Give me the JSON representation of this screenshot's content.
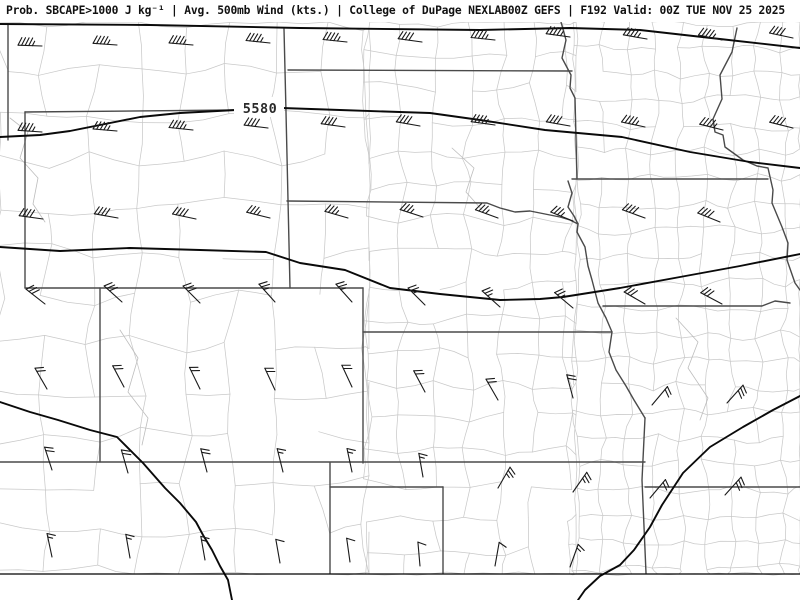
{
  "title": {
    "text": "Prob. SBCAPE>1000 J kg⁻¹ | Avg. 500mb Wind (kts.) | College of DuPage NEXLAB00Z GEFS | F192 Valid: 00Z TUE NOV 25 2025"
  },
  "map": {
    "width": 800,
    "height": 600,
    "top": 22,
    "bottom_frame_y": 574,
    "background": "#ffffff",
    "colors": {
      "county": "#c9c9c9",
      "state_border": "#4a4a4a",
      "contour": "#0a0a0a",
      "wind_barb": "#1a1a1a",
      "frame": "#000000",
      "title_text": "#111111",
      "label_text": "#2a2a2a",
      "decor_river": "#bdbdbd"
    },
    "contour_label": {
      "text": "5580",
      "x": 260,
      "y": 113,
      "box": {
        "x": 234,
        "y": 97,
        "w": 50,
        "h": 20
      }
    },
    "county_regions": [
      {
        "x0": 0,
        "y0": 22,
        "x1": 369,
        "y1": 574,
        "cell": 46,
        "jitter": 9,
        "drop": 0.22,
        "seed": 7
      },
      {
        "x0": 369,
        "y0": 22,
        "x1": 576,
        "y1": 574,
        "cell": 33,
        "jitter": 6,
        "drop": 0.12,
        "seed": 13
      },
      {
        "x0": 576,
        "y0": 22,
        "x1": 800,
        "y1": 574,
        "cell": 26,
        "jitter": 5,
        "drop": 0.07,
        "seed": 29
      }
    ],
    "decor_rivers": [
      [
        [
          10,
          118
        ],
        [
          28,
          132
        ],
        [
          20,
          158
        ],
        [
          38,
          178
        ],
        [
          33,
          204
        ],
        [
          45,
          222
        ]
      ],
      [
        [
          120,
          330
        ],
        [
          138,
          358
        ],
        [
          128,
          392
        ],
        [
          148,
          418
        ],
        [
          142,
          445
        ]
      ],
      [
        [
          452,
          148
        ],
        [
          474,
          168
        ],
        [
          466,
          192
        ],
        [
          482,
          210
        ]
      ],
      [
        [
          676,
          318
        ],
        [
          698,
          342
        ],
        [
          688,
          368
        ],
        [
          708,
          398
        ],
        [
          700,
          420
        ]
      ]
    ],
    "state_lines": [
      [
        [
          8,
          24
        ],
        [
          8,
          140
        ]
      ],
      [
        [
          25,
          112
        ],
        [
          236,
          110
        ]
      ],
      [
        [
          25,
          112
        ],
        [
          25,
          288
        ]
      ],
      [
        [
          284,
          29
        ],
        [
          286,
          112
        ],
        [
          290,
          288
        ]
      ],
      [
        [
          288,
          70
        ],
        [
          572,
          71
        ]
      ],
      [
        [
          287,
          201
        ],
        [
          487,
          203
        ],
        [
          500,
          208
        ],
        [
          515,
          212
        ],
        [
          530,
          211
        ],
        [
          545,
          214
        ],
        [
          560,
          217
        ],
        [
          570,
          220
        ],
        [
          578,
          224
        ]
      ],
      [
        [
          561,
          22
        ],
        [
          566,
          40
        ],
        [
          562,
          58
        ],
        [
          571,
          75
        ],
        [
          570,
          88
        ],
        [
          575,
          98
        ],
        [
          577,
          179
        ]
      ],
      [
        [
          572,
          179
        ],
        [
          768,
          179
        ]
      ],
      [
        [
          568,
          181
        ],
        [
          572,
          193
        ],
        [
          568,
          207
        ],
        [
          574,
          216
        ],
        [
          578,
          224
        ],
        [
          577,
          232
        ],
        [
          585,
          247
        ],
        [
          588,
          266
        ],
        [
          592,
          280
        ],
        [
          598,
          303
        ],
        [
          606,
          318
        ],
        [
          612,
          332
        ],
        [
          609,
          352
        ],
        [
          616,
          370
        ],
        [
          626,
          386
        ],
        [
          634,
          400
        ],
        [
          645,
          418
        ]
      ],
      [
        [
          603,
          306
        ],
        [
          700,
          306
        ],
        [
          762,
          306
        ],
        [
          775,
          301
        ],
        [
          790,
          303
        ]
      ],
      [
        [
          25,
          288
        ],
        [
          363,
          288
        ]
      ],
      [
        [
          100,
          288
        ],
        [
          100,
          462
        ]
      ],
      [
        [
          363,
          288
        ],
        [
          363,
          463
        ]
      ],
      [
        [
          363,
          332
        ],
        [
          612,
          332
        ]
      ],
      [
        [
          0,
          462
        ],
        [
          645,
          462
        ]
      ],
      [
        [
          645,
          418
        ],
        [
          642,
          480
        ],
        [
          646,
          573
        ]
      ],
      [
        [
          645,
          487
        ],
        [
          800,
          487
        ]
      ],
      [
        [
          330,
          463
        ],
        [
          330,
          573
        ]
      ],
      [
        [
          330,
          487
        ],
        [
          443,
          487
        ]
      ],
      [
        [
          443,
          487
        ],
        [
          443,
          573
        ]
      ],
      [
        [
          737,
          28
        ],
        [
          732,
          52
        ],
        [
          720,
          75
        ],
        [
          722,
          99
        ],
        [
          713,
          119
        ],
        [
          715,
          132
        ],
        [
          723,
          135
        ],
        [
          725,
          147
        ],
        [
          743,
          160
        ],
        [
          757,
          166
        ],
        [
          768,
          168
        ],
        [
          773,
          190
        ],
        [
          772,
          203
        ],
        [
          782,
          227
        ],
        [
          788,
          243
        ],
        [
          787,
          260
        ],
        [
          795,
          283
        ],
        [
          800,
          290
        ]
      ]
    ],
    "contours": [
      [
        [
          0,
          24
        ],
        [
          150,
          25
        ],
        [
          300,
          28
        ],
        [
          480,
          30
        ],
        [
          570,
          28
        ],
        [
          640,
          30
        ],
        [
          720,
          39
        ],
        [
          800,
          48
        ]
      ],
      [
        [
          0,
          137
        ],
        [
          40,
          135
        ],
        [
          70,
          131
        ],
        [
          100,
          125
        ],
        [
          140,
          117
        ],
        [
          180,
          113
        ],
        [
          236,
          110
        ]
      ],
      [
        [
          282,
          108
        ],
        [
          340,
          110
        ],
        [
          430,
          113
        ],
        [
          480,
          120
        ],
        [
          545,
          130
        ],
        [
          622,
          137
        ],
        [
          690,
          152
        ],
        [
          750,
          162
        ],
        [
          800,
          168
        ]
      ],
      [
        [
          0,
          247
        ],
        [
          60,
          251
        ],
        [
          130,
          248
        ],
        [
          200,
          250
        ],
        [
          266,
          252
        ],
        [
          300,
          263
        ],
        [
          345,
          270
        ],
        [
          390,
          288
        ],
        [
          440,
          294
        ],
        [
          500,
          300
        ],
        [
          540,
          299
        ],
        [
          563,
          297
        ],
        [
          620,
          288
        ],
        [
          680,
          277
        ],
        [
          740,
          266
        ],
        [
          800,
          254
        ]
      ],
      [
        [
          800,
          396
        ],
        [
          773,
          410
        ],
        [
          743,
          427
        ],
        [
          710,
          447
        ],
        [
          683,
          473
        ],
        [
          662,
          505
        ],
        [
          650,
          527
        ],
        [
          634,
          550
        ],
        [
          620,
          565
        ],
        [
          600,
          576
        ],
        [
          585,
          590
        ],
        [
          578,
          600
        ]
      ],
      [
        [
          0,
          402
        ],
        [
          30,
          412
        ],
        [
          58,
          420
        ],
        [
          90,
          430
        ],
        [
          117,
          437
        ],
        [
          143,
          463
        ],
        [
          165,
          488
        ],
        [
          180,
          503
        ],
        [
          196,
          522
        ],
        [
          203,
          535
        ],
        [
          212,
          550
        ],
        [
          220,
          566
        ],
        [
          228,
          580
        ],
        [
          232,
          600
        ]
      ]
    ],
    "barb_style": {
      "staff": 24,
      "full_len": 8.5,
      "half_len": 5,
      "spacing": 3.6,
      "tick_angle": 115,
      "width": 1.1
    },
    "wind_barbs": [
      {
        "x": 42,
        "y": 46,
        "spd": 45,
        "dir": 272
      },
      {
        "x": 117,
        "y": 45,
        "spd": 45,
        "dir": 274
      },
      {
        "x": 193,
        "y": 45,
        "spd": 45,
        "dir": 275
      },
      {
        "x": 270,
        "y": 43,
        "spd": 45,
        "dir": 276
      },
      {
        "x": 347,
        "y": 42,
        "spd": 45,
        "dir": 276
      },
      {
        "x": 422,
        "y": 42,
        "spd": 40,
        "dir": 278
      },
      {
        "x": 495,
        "y": 40,
        "spd": 45,
        "dir": 276
      },
      {
        "x": 570,
        "y": 37,
        "spd": 45,
        "dir": 278
      },
      {
        "x": 647,
        "y": 39,
        "spd": 45,
        "dir": 280
      },
      {
        "x": 722,
        "y": 40,
        "spd": 45,
        "dir": 282
      },
      {
        "x": 793,
        "y": 38,
        "spd": 40,
        "dir": 282
      },
      {
        "x": 42,
        "y": 132,
        "spd": 45,
        "dir": 274
      },
      {
        "x": 117,
        "y": 131,
        "spd": 45,
        "dir": 275
      },
      {
        "x": 193,
        "y": 130,
        "spd": 45,
        "dir": 276
      },
      {
        "x": 268,
        "y": 128,
        "spd": 40,
        "dir": 277
      },
      {
        "x": 345,
        "y": 127,
        "spd": 40,
        "dir": 278
      },
      {
        "x": 420,
        "y": 126,
        "spd": 40,
        "dir": 280
      },
      {
        "x": 495,
        "y": 125,
        "spd": 45,
        "dir": 278
      },
      {
        "x": 570,
        "y": 126,
        "spd": 40,
        "dir": 280
      },
      {
        "x": 645,
        "y": 127,
        "spd": 45,
        "dir": 282
      },
      {
        "x": 723,
        "y": 130,
        "spd": 45,
        "dir": 284
      },
      {
        "x": 793,
        "y": 128,
        "spd": 40,
        "dir": 284
      },
      {
        "x": 43,
        "y": 219,
        "spd": 40,
        "dir": 278
      },
      {
        "x": 118,
        "y": 218,
        "spd": 40,
        "dir": 280
      },
      {
        "x": 196,
        "y": 219,
        "spd": 40,
        "dir": 282
      },
      {
        "x": 270,
        "y": 218,
        "spd": 35,
        "dir": 284
      },
      {
        "x": 348,
        "y": 218,
        "spd": 35,
        "dir": 286
      },
      {
        "x": 423,
        "y": 217,
        "spd": 35,
        "dir": 288
      },
      {
        "x": 498,
        "y": 218,
        "spd": 35,
        "dir": 290
      },
      {
        "x": 573,
        "y": 221,
        "spd": 35,
        "dir": 292
      },
      {
        "x": 645,
        "y": 218,
        "spd": 40,
        "dir": 290
      },
      {
        "x": 720,
        "y": 222,
        "spd": 40,
        "dir": 292
      },
      {
        "x": 45,
        "y": 304,
        "spd": 30,
        "dir": 308
      },
      {
        "x": 122,
        "y": 302,
        "spd": 30,
        "dir": 312
      },
      {
        "x": 200,
        "y": 303,
        "spd": 30,
        "dir": 315
      },
      {
        "x": 275,
        "y": 302,
        "spd": 25,
        "dir": 318
      },
      {
        "x": 352,
        "y": 302,
        "spd": 25,
        "dir": 318
      },
      {
        "x": 425,
        "y": 305,
        "spd": 25,
        "dir": 315
      },
      {
        "x": 500,
        "y": 307,
        "spd": 25,
        "dir": 312
      },
      {
        "x": 573,
        "y": 308,
        "spd": 25,
        "dir": 310
      },
      {
        "x": 645,
        "y": 304,
        "spd": 30,
        "dir": 300
      },
      {
        "x": 722,
        "y": 304,
        "spd": 30,
        "dir": 298
      },
      {
        "x": 47,
        "y": 389,
        "spd": 20,
        "dir": 330
      },
      {
        "x": 124,
        "y": 387,
        "spd": 20,
        "dir": 332
      },
      {
        "x": 200,
        "y": 389,
        "spd": 20,
        "dir": 334
      },
      {
        "x": 275,
        "y": 390,
        "spd": 20,
        "dir": 335
      },
      {
        "x": 352,
        "y": 387,
        "spd": 20,
        "dir": 335
      },
      {
        "x": 425,
        "y": 392,
        "spd": 20,
        "dir": 332
      },
      {
        "x": 498,
        "y": 400,
        "spd": 20,
        "dir": 330
      },
      {
        "x": 573,
        "y": 398,
        "spd": 20,
        "dir": 345
      },
      {
        "x": 652,
        "y": 405,
        "spd": 20,
        "dir": 40
      },
      {
        "x": 727,
        "y": 403,
        "spd": 30,
        "dir": 42
      },
      {
        "x": 52,
        "y": 470,
        "spd": 20,
        "dir": 342
      },
      {
        "x": 128,
        "y": 473,
        "spd": 20,
        "dir": 344
      },
      {
        "x": 207,
        "y": 472,
        "spd": 20,
        "dir": 345
      },
      {
        "x": 283,
        "y": 472,
        "spd": 15,
        "dir": 346
      },
      {
        "x": 352,
        "y": 472,
        "spd": 15,
        "dir": 348
      },
      {
        "x": 423,
        "y": 477,
        "spd": 15,
        "dir": 350
      },
      {
        "x": 498,
        "y": 488,
        "spd": 25,
        "dir": 30
      },
      {
        "x": 573,
        "y": 492,
        "spd": 25,
        "dir": 35
      },
      {
        "x": 650,
        "y": 498,
        "spd": 20,
        "dir": 40
      },
      {
        "x": 725,
        "y": 495,
        "spd": 30,
        "dir": 42
      },
      {
        "x": 52,
        "y": 557,
        "spd": 15,
        "dir": 348
      },
      {
        "x": 130,
        "y": 558,
        "spd": 15,
        "dir": 350
      },
      {
        "x": 205,
        "y": 560,
        "spd": 15,
        "dir": 350
      },
      {
        "x": 280,
        "y": 563,
        "spd": 10,
        "dir": 350
      },
      {
        "x": 350,
        "y": 562,
        "spd": 10,
        "dir": 352
      },
      {
        "x": 420,
        "y": 566,
        "spd": 10,
        "dir": 355
      },
      {
        "x": 495,
        "y": 566,
        "spd": 10,
        "dir": 10
      },
      {
        "x": 570,
        "y": 567,
        "spd": 15,
        "dir": 20
      }
    ]
  }
}
